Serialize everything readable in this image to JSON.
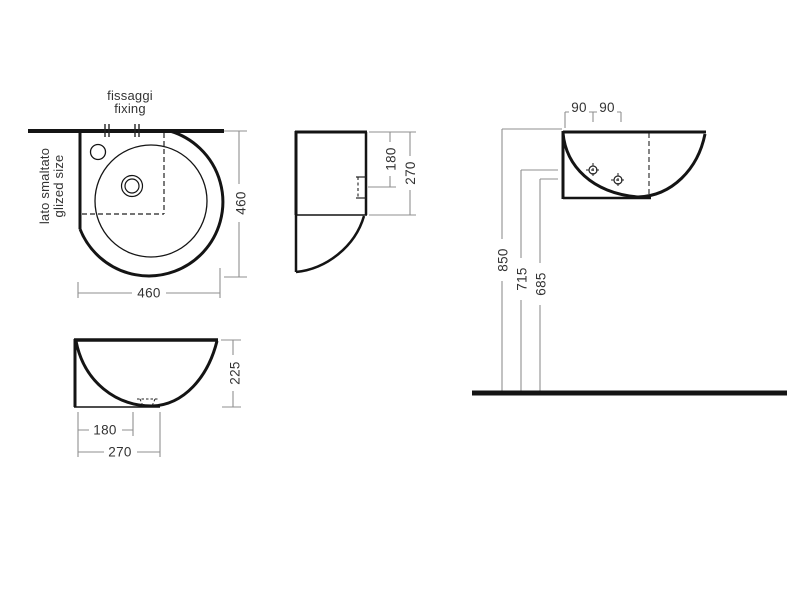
{
  "colors": {
    "background": "#ffffff",
    "outline": "#141414",
    "dimension_line": "#8f8f8f",
    "label_text": "#333333"
  },
  "plan": {
    "fixing_label_line1": "fissaggi",
    "fixing_label_line2": "fixing",
    "glazed_side_line1": "lato smaltato",
    "glazed_side_line2": "glized size",
    "depth_dim": "460",
    "width_dim": "460"
  },
  "side": {
    "drain_depth_dim": "180",
    "total_depth_dim": "270"
  },
  "front": {
    "height_dim": "225",
    "drain_offset_dim": "180",
    "base_width_dim": "270"
  },
  "wall": {
    "fixing_spacing_left": "90",
    "fixing_spacing_right": "90",
    "rim_height_dim": "850",
    "fixing_height_dim_1": "715",
    "fixing_height_dim_2": "685"
  }
}
